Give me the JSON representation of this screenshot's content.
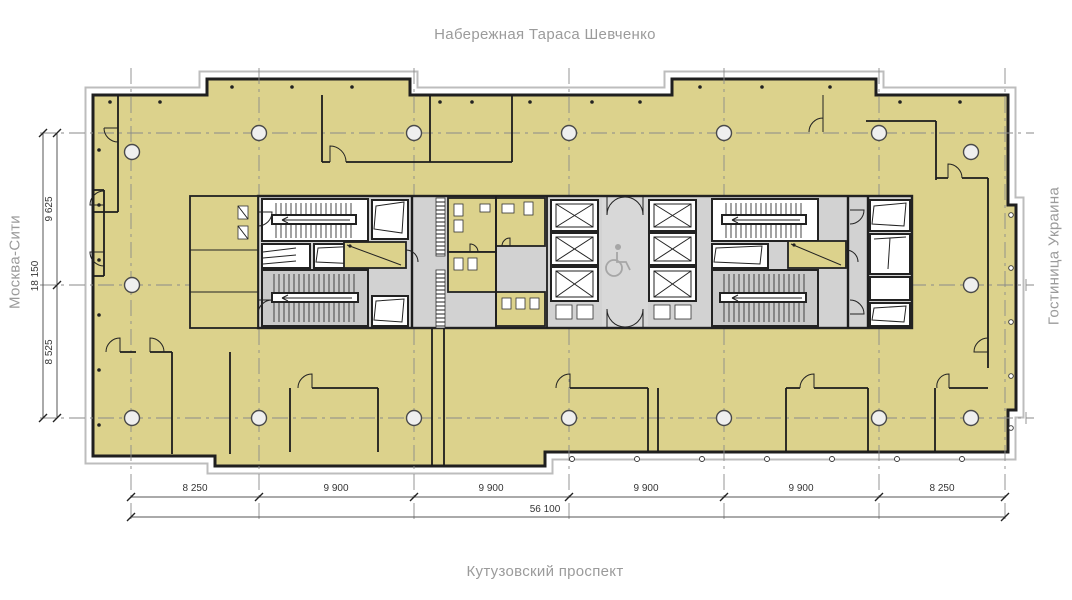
{
  "streets": {
    "top": "Набережная Тараса Шевченко",
    "bottom": "Кутузовский проспект",
    "left": "Москва-Сити",
    "right": "Гостиница Украина"
  },
  "dimensions": {
    "left_segments": [
      "9 625",
      "8 525"
    ],
    "left_total": "18 150",
    "bottom_segments": [
      "8 250",
      "9 900",
      "9 900",
      "9 900",
      "9 900",
      "8 250"
    ],
    "bottom_total": "56 100"
  },
  "icons": {
    "wheelchair": "♿",
    "elevator_shaft": "crossed-box",
    "stairs": "hatched-flight",
    "column": "circle-on-grid-axis"
  },
  "colors": {
    "floor": "#DCD28C",
    "core": "#D2D2D2",
    "lobby": "#D8D8D8",
    "stair": "#C9C9C9",
    "wall": "#1F1F1F",
    "grid": "#8A8A8A",
    "band": "#BDBDBD",
    "dim": "#353535",
    "street": "#9B9B9B"
  }
}
